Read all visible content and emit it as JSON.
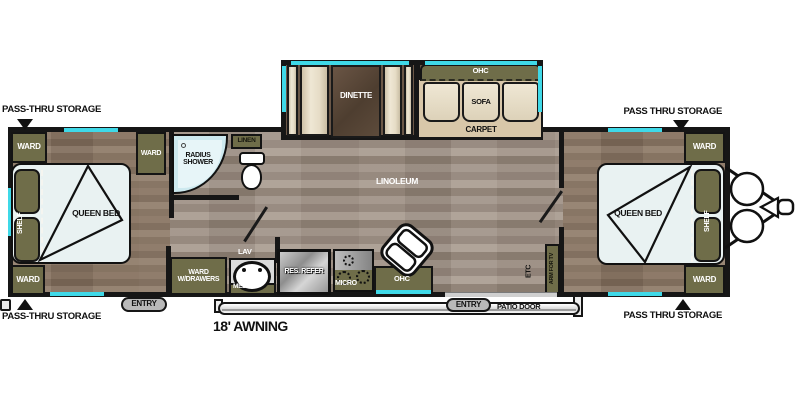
{
  "floorplan": {
    "exterior": {
      "pass_thru_front_left": "PASS-THRU STORAGE",
      "pass_thru_front_right": "PASS THRU STORAGE",
      "pass_thru_rear_left": "PASS-THRU STORAGE",
      "pass_thru_rear_right": "PASS THRU STORAGE",
      "awning": "18' AWNING",
      "entry_front": "ENTRY",
      "entry_rear": "ENTRY",
      "patio_door": "PATIO DOOR"
    },
    "bedroom_left": {
      "ward_front": "WARD",
      "ward_inner": "WARD",
      "ward_rear": "WARD",
      "shelf": "SHELF",
      "bed": "QUEEN BED"
    },
    "bathroom": {
      "radius_shower": "RADIUS SHOWER",
      "linen": "LINEN",
      "lav": "LAV",
      "med": "MED",
      "ward_w_drawers": "WARD W/DRAWERS"
    },
    "kitchen": {
      "res_refer": "RES. REFER",
      "micro": "MICRO",
      "ohc": "OHC"
    },
    "living": {
      "dinette": "DINETTE",
      "sofa": "SOFA",
      "ohc": "OHC",
      "carpet": "CARPET",
      "linoleum": "LINOLEUM"
    },
    "bedroom_right": {
      "ward_front": "WARD",
      "ward_rear": "WARD",
      "shelf": "SHELF",
      "bed": "QUEEN BED",
      "etc": "ETC",
      "arm_for_tv": "ARM FOR TV"
    },
    "colors": {
      "wall": "#161616",
      "cabinet_olive": "#6f6d49",
      "accent_teal": "#3fd9e8",
      "mattress": "#e9f2f2",
      "shower_blue": "#cde9ef",
      "carpet_tan": "#d8c7a9",
      "cushion_cream": "#e8dfca",
      "table_brown": "#5d4b3b",
      "floor_linoleum": "#9c8d7f",
      "floor_bedroom": "#85725f"
    }
  }
}
